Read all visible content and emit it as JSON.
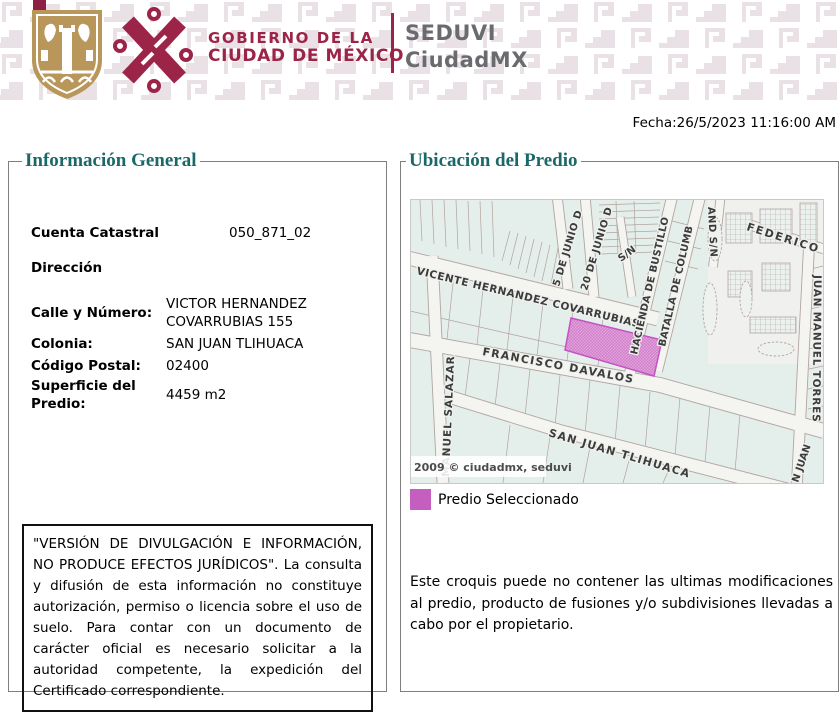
{
  "header": {
    "brand_line1": "GOBIERNO DE LA",
    "brand_line2": "CIUDAD DE MÉXICO",
    "org_line1": "SEDUVI",
    "org_line2": "CiudadMX",
    "colors": {
      "maroon": "#9d2449",
      "shield_gold": "#b9975b",
      "pattern_pink": "#e9e1e6",
      "org_gray": "#6a6b6e"
    }
  },
  "date_line": "Fecha:26/5/2023 11:16:00 AM",
  "general_info": {
    "title": "Información General",
    "fields": [
      {
        "label": "Cuenta Catastral",
        "value": "050_871_02"
      },
      {
        "label": "Dirección",
        "value": ""
      },
      {
        "label": "Calle y Número:",
        "value": "VICTOR HERNANDEZ COVARRUBIAS 155"
      },
      {
        "label": "Colonia:",
        "value": "SAN JUAN TLIHUACA"
      },
      {
        "label": "Código Postal:",
        "value": "02400"
      },
      {
        "label": "Superficie del Predio:",
        "value": "4459 m2"
      }
    ],
    "disclaimer": "\"VERSIÓN DE DIVULGACIÓN E INFORMACIÓN, NO PRODUCE EFECTOS JURÍDICOS\". La consulta y difusión de esta información no constituye autorización, permiso o licencia sobre el uso de suelo. Para contar con un documento de carácter oficial es necesario solicitar a la autoridad competente, la expedición del Certificado correspondiente."
  },
  "map_panel": {
    "title": "Ubicación del Predio",
    "watermark": "2009 © ciudadmx, seduvi",
    "legend_label": "Predio Seleccionado",
    "note": "Este croquis puede no contener las ultimas modificaciones al predio, producto de fusiones y/o subdivisiones llevadas a cabo por el propietario.",
    "colors": {
      "selected_parcel": "#c45fc0",
      "parcel_teal": "#e4eeea",
      "title_teal": "#1b6868"
    },
    "streets": {
      "vicente": "VICENTE HERNANDEZ COVARRUBIAS",
      "francisco": "FRANCISCO DAVALOS",
      "sanjuan": "SAN JUAN TLIHUACA",
      "manuel": "MANUEL SALAZAR",
      "junio5": "5 DE JUNIO D",
      "junio20": "20 DE JUNIO D",
      "sn": "S/N",
      "hacienda": "HACIENDA DE BUSTILLO",
      "batalla": "BATALLA DE COLUMB",
      "andsn": "AND S/N",
      "federico": "FEDERICO .",
      "torres": "JUAN MANUEL TORRES",
      "njuan": "N JUAN"
    }
  }
}
